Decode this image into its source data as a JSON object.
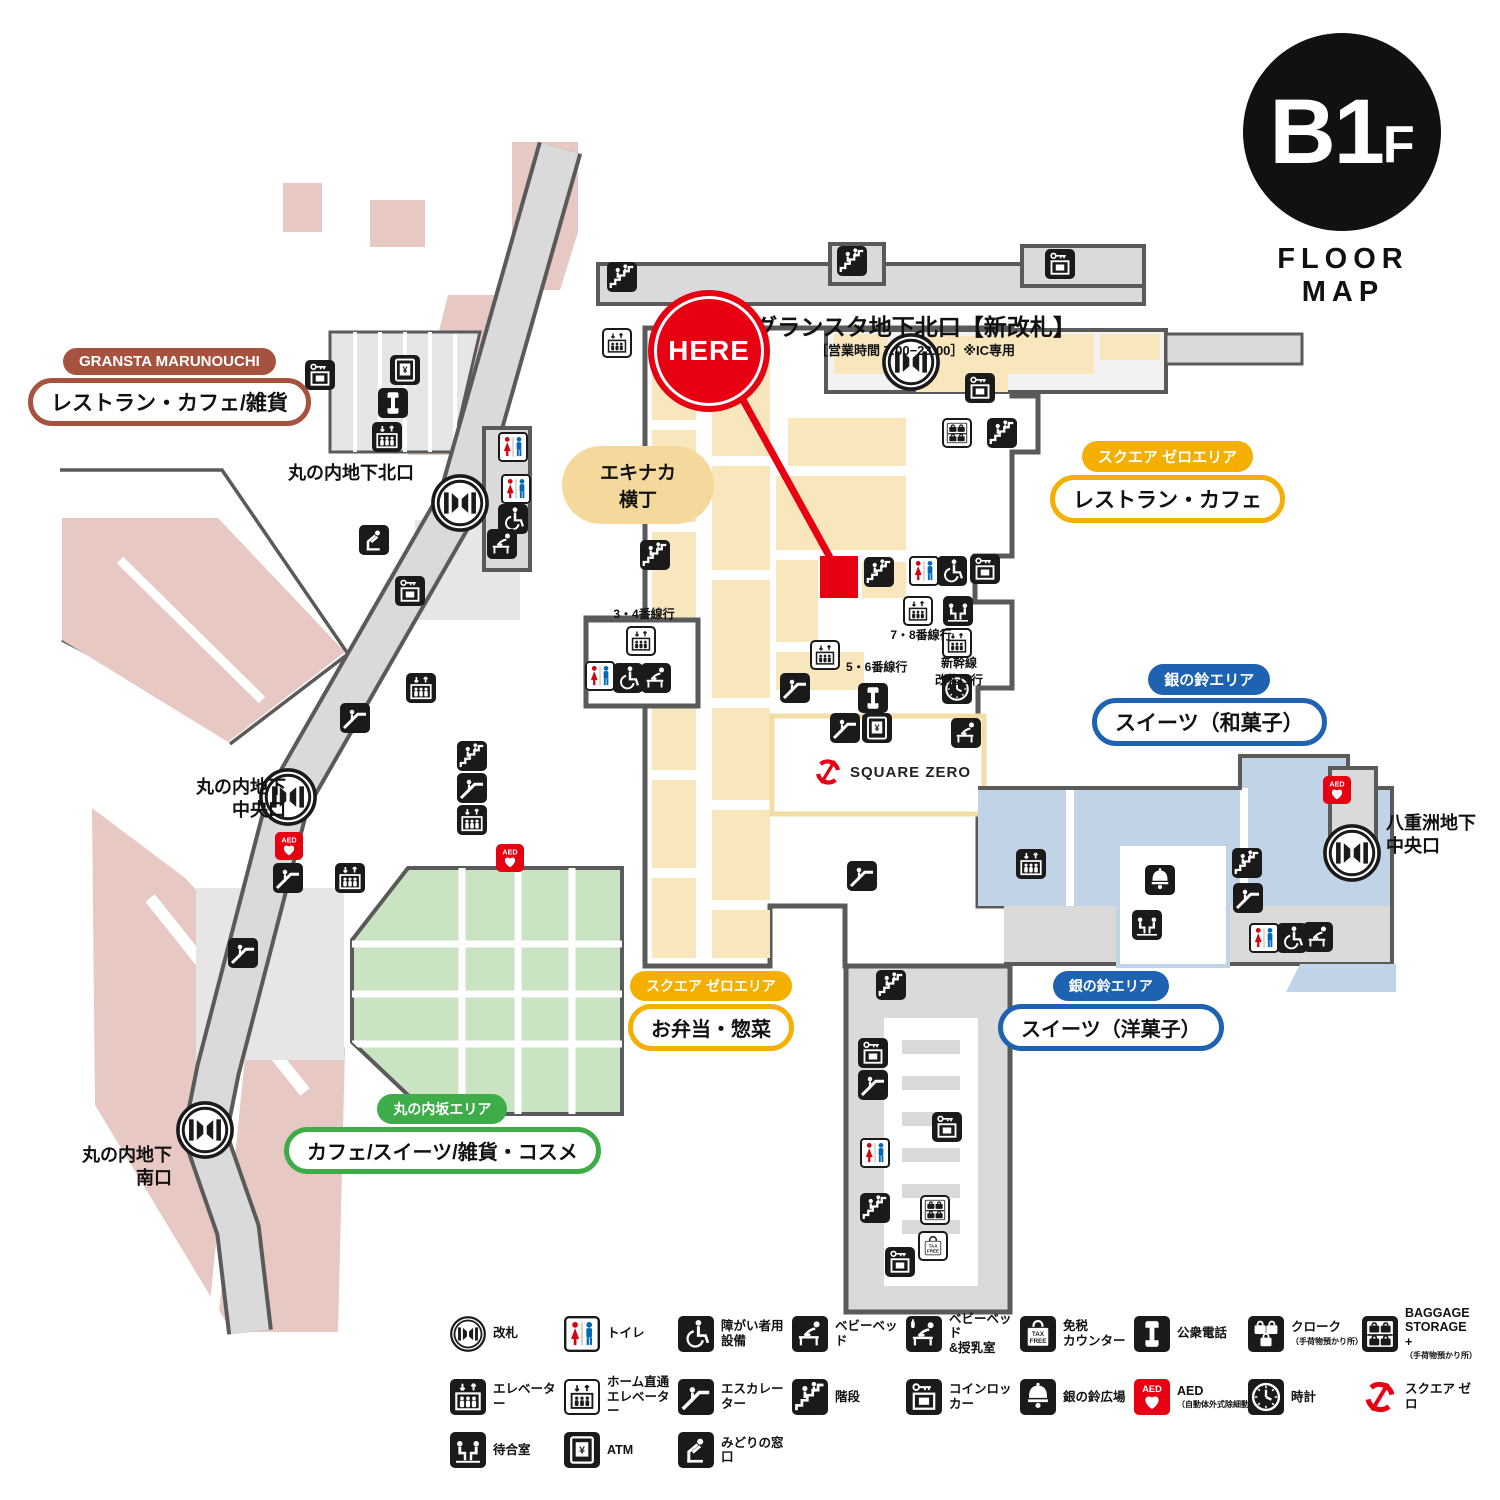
{
  "floor_badge": {
    "level": "B1",
    "level_suffix": "F",
    "caption": "FLOOR MAP"
  },
  "here_marker": {
    "label": "HERE"
  },
  "gates": {
    "gransta_north": {
      "title": "グランスタ地下北口【新改札】",
      "subtitle": "［営業時間 7:00−23:00］※IC専用"
    },
    "marunouchi_north": {
      "title": "丸の内地下北口"
    },
    "marunouchi_central": {
      "title": "丸の内地下\n中央口"
    },
    "yaesu_central": {
      "title": "八重洲地下\n中央口"
    },
    "marunouchi_south": {
      "title": "丸の内地下\n南口"
    }
  },
  "areas": [
    {
      "badge": "GRANSTA MARUNOUCHI",
      "label": "レストラン・カフェ/雑貨",
      "color": "#A6523E"
    },
    {
      "badge": "スクエア ゼロエリア",
      "label": "レストラン・カフェ",
      "color": "#F5AF00"
    },
    {
      "badge": "銀の鈴エリア",
      "label": "スイーツ（和菓子）",
      "color": "#1D63B2"
    },
    {
      "badge": "スクエア ゼロエリア",
      "label": "お弁当・惣菜",
      "color": "#F5AF00"
    },
    {
      "badge": "銀の鈴エリア",
      "label": "スイーツ（洋菓子）",
      "color": "#1D63B2"
    },
    {
      "badge": "丸の内坂エリア",
      "label": "カフェ/スイーツ/雑貨・コスメ",
      "color": "#3EAD49"
    }
  ],
  "map_texts": {
    "ekinaka": "エキナカ\n横丁",
    "square_zero": "SQUARE ZERO",
    "track_3_4": "3・4番線行",
    "track_5_6": "5・6番線行",
    "track_7_8": "7・8番線行",
    "shinkansen": "新幹線\n改札口行"
  },
  "legend": {
    "rows": [
      [
        {
          "icon": "gate",
          "label": "改札"
        },
        {
          "icon": "toilet",
          "label": "トイレ"
        },
        {
          "icon": "wheelchair",
          "label": "障がい者用\n設備"
        },
        {
          "icon": "baby-bed",
          "label": "ベビーベッド"
        },
        {
          "icon": "nursing",
          "label": "ベビーベッド\n&授乳室"
        },
        {
          "icon": "taxfree",
          "label": "免税\nカウンター"
        },
        {
          "icon": "phone",
          "label": "公衆電話"
        },
        {
          "icon": "cloak",
          "label": "クローク",
          "sub": "（手荷物預かり所）"
        },
        {
          "icon": "baggage",
          "label": "BAGGAGE\nSTORAGE +",
          "sub": "（手荷物預かり所）"
        }
      ],
      [
        {
          "icon": "elevator",
          "label": "エレベーター"
        },
        {
          "icon": "home-elevator",
          "label": "ホーム直通\nエレベーター"
        },
        {
          "icon": "escalator",
          "label": "エスカレーター"
        },
        {
          "icon": "stairs",
          "label": "階段"
        },
        {
          "icon": "coin-locker",
          "label": "コインロッカー"
        },
        {
          "icon": "bell",
          "label": "銀の鈴広場"
        },
        {
          "icon": "aed",
          "label": "AED",
          "sub": "（自動体外式除細動器）"
        },
        {
          "icon": "clock",
          "label": "時計"
        },
        {
          "icon": "square-zero",
          "label": "スクエア ゼロ"
        }
      ],
      [
        {
          "icon": "waiting",
          "label": "待合室"
        },
        {
          "icon": "atm",
          "label": "ATM"
        },
        {
          "icon": "midori",
          "label": "みどりの窓口"
        }
      ]
    ]
  },
  "map_icons": [
    {
      "type": "stairs",
      "x": 622,
      "y": 277
    },
    {
      "type": "stairs",
      "x": 852,
      "y": 261
    },
    {
      "type": "coin-locker",
      "x": 1060,
      "y": 264
    },
    {
      "type": "home-elevator",
      "x": 617,
      "y": 343
    },
    {
      "type": "gate",
      "x": 911,
      "y": 362,
      "size": 58
    },
    {
      "type": "coin-locker",
      "x": 980,
      "y": 388
    },
    {
      "type": "baggage-white",
      "x": 957,
      "y": 433
    },
    {
      "type": "stairs",
      "x": 1002,
      "y": 433
    },
    {
      "type": "coin-locker",
      "x": 320,
      "y": 375
    },
    {
      "type": "atm",
      "x": 405,
      "y": 370
    },
    {
      "type": "phone",
      "x": 393,
      "y": 403
    },
    {
      "type": "elevator",
      "x": 387,
      "y": 437
    },
    {
      "type": "toilet",
      "x": 513,
      "y": 447
    },
    {
      "type": "toilet",
      "x": 516,
      "y": 489
    },
    {
      "type": "wheelchair",
      "x": 513,
      "y": 519
    },
    {
      "type": "baby-bed",
      "x": 502,
      "y": 544
    },
    {
      "type": "gate",
      "x": 460,
      "y": 503,
      "size": 58
    },
    {
      "type": "midori",
      "x": 374,
      "y": 540
    },
    {
      "type": "coin-locker",
      "x": 410,
      "y": 591
    },
    {
      "type": "elevator",
      "x": 421,
      "y": 688
    },
    {
      "type": "escalator",
      "x": 355,
      "y": 718
    },
    {
      "type": "stairs",
      "x": 472,
      "y": 756
    },
    {
      "type": "escalator",
      "x": 472,
      "y": 788
    },
    {
      "type": "elevator",
      "x": 472,
      "y": 820
    },
    {
      "type": "gate",
      "x": 288,
      "y": 797,
      "size": 58
    },
    {
      "type": "aed",
      "x": 289,
      "y": 846,
      "size": 28
    },
    {
      "type": "escalator",
      "x": 288,
      "y": 878
    },
    {
      "type": "elevator",
      "x": 350,
      "y": 878
    },
    {
      "type": "aed",
      "x": 510,
      "y": 858,
      "size": 28
    },
    {
      "type": "escalator",
      "x": 243,
      "y": 953
    },
    {
      "type": "gate",
      "x": 205,
      "y": 1130,
      "size": 58
    },
    {
      "type": "stairs",
      "x": 655,
      "y": 555
    },
    {
      "type": "home-elevator",
      "x": 641,
      "y": 641
    },
    {
      "type": "toilet",
      "x": 600,
      "y": 676
    },
    {
      "type": "wheelchair",
      "x": 628,
      "y": 678
    },
    {
      "type": "baby-bed",
      "x": 656,
      "y": 678
    },
    {
      "type": "home-elevator",
      "x": 825,
      "y": 655
    },
    {
      "type": "escalator",
      "x": 795,
      "y": 688
    },
    {
      "type": "phone",
      "x": 873,
      "y": 698
    },
    {
      "type": "escalator",
      "x": 845,
      "y": 728
    },
    {
      "type": "atm",
      "x": 877,
      "y": 728
    },
    {
      "type": "home-elevator",
      "x": 918,
      "y": 611
    },
    {
      "type": "waiting",
      "x": 958,
      "y": 611
    },
    {
      "type": "home-elevator",
      "x": 957,
      "y": 643
    },
    {
      "type": "clock",
      "x": 957,
      "y": 689
    },
    {
      "type": "baby-bed",
      "x": 966,
      "y": 733
    },
    {
      "type": "stairs",
      "x": 879,
      "y": 572
    },
    {
      "type": "toilet",
      "x": 924,
      "y": 571
    },
    {
      "type": "wheelchair",
      "x": 952,
      "y": 571
    },
    {
      "type": "coin-locker",
      "x": 985,
      "y": 569
    },
    {
      "type": "square-zero",
      "x": 828,
      "y": 772,
      "size": 30
    },
    {
      "type": "escalator",
      "x": 862,
      "y": 876
    },
    {
      "type": "elevator",
      "x": 1031,
      "y": 864
    },
    {
      "type": "bell",
      "x": 1160,
      "y": 880
    },
    {
      "type": "waiting",
      "x": 1147,
      "y": 925
    },
    {
      "type": "stairs",
      "x": 1247,
      "y": 863
    },
    {
      "type": "escalator",
      "x": 1248,
      "y": 898
    },
    {
      "type": "toilet",
      "x": 1264,
      "y": 938
    },
    {
      "type": "wheelchair",
      "x": 1292,
      "y": 938
    },
    {
      "type": "baby-bed",
      "x": 1318,
      "y": 937
    },
    {
      "type": "aed",
      "x": 1337,
      "y": 790,
      "size": 28
    },
    {
      "type": "gate",
      "x": 1352,
      "y": 853,
      "size": 58
    },
    {
      "type": "stairs",
      "x": 891,
      "y": 985
    },
    {
      "type": "coin-locker",
      "x": 873,
      "y": 1053
    },
    {
      "type": "escalator",
      "x": 873,
      "y": 1085
    },
    {
      "type": "toilet",
      "x": 875,
      "y": 1153
    },
    {
      "type": "stairs",
      "x": 875,
      "y": 1208
    },
    {
      "type": "coin-locker",
      "x": 947,
      "y": 1127
    },
    {
      "type": "baggage-white",
      "x": 935,
      "y": 1210
    },
    {
      "type": "taxfree-white",
      "x": 933,
      "y": 1246
    },
    {
      "type": "coin-locker",
      "x": 900,
      "y": 1262
    }
  ],
  "colors": {
    "red": "#E60012",
    "pink": "#E7C8C3",
    "cream": "#F8E6BC",
    "green": "#CAE4C3",
    "blue": "#C0D3E7",
    "corridor": "#DADADB",
    "wall": "#5A5A5A",
    "area_yellow": "#F5AF00",
    "area_blue": "#1D63B2",
    "area_green": "#3EAD49",
    "area_brown": "#A6523E"
  }
}
